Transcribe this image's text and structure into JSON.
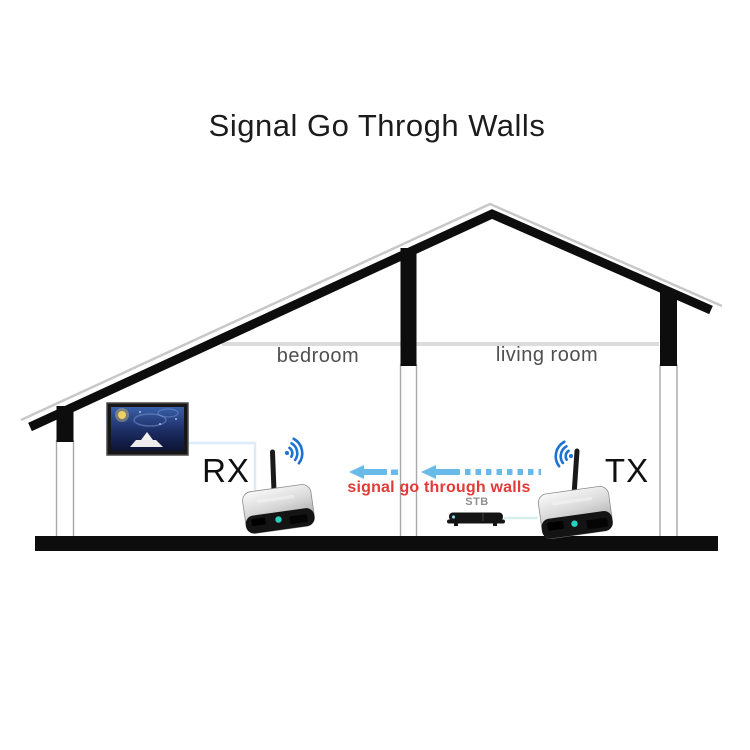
{
  "title": "Signal Go Throgh Walls",
  "rooms": {
    "bedroom": "bedroom",
    "living_room": "living room"
  },
  "devices": {
    "receiver_label": "RX",
    "transmitter_label": "TX",
    "stb_label": "STB"
  },
  "annotations": {
    "signal_path": "signal go through walls"
  },
  "icons": {
    "rx_wifi": "wifi-waves-right-icon",
    "tx_wifi": "wifi-waves-left-icon",
    "signal_arrows": "left-arrow-icon"
  },
  "colors": {
    "wifi_blue": "#1d72d2",
    "arrow_blue": "#69b9e9",
    "signal_red": "#e23a36",
    "structure_black": "#0d0d0d",
    "ceiling_grey": "#dcdcdc",
    "room_label_grey": "#4f4f4f",
    "stb_label_grey": "#909090"
  }
}
